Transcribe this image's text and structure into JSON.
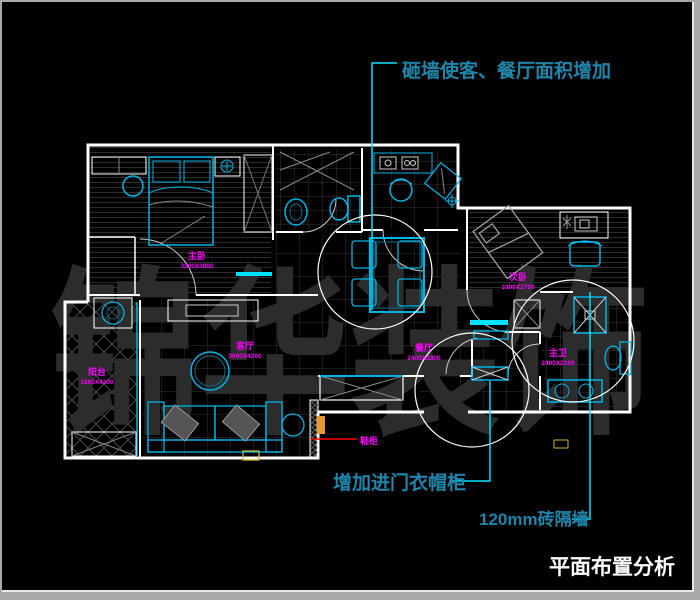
{
  "meta": {
    "background": "#000000",
    "frame_color": "#a9a9a9",
    "wall_color": "#ffffff",
    "furniture_color": "#00b4e6",
    "label_color": "#ff00ff",
    "annotation_text_color": "#1e86ab",
    "leader_color": "#00e0ff"
  },
  "title": {
    "text": "平面布置分析",
    "color": "#ffffff"
  },
  "watermark": {
    "text": "锦华装饰",
    "color": "#2c2c2c"
  },
  "annotations": {
    "demolish_wall": {
      "text": "砸墙使客、餐厅面积增加"
    },
    "coat_cabinet": {
      "text": "增加进门衣帽柜"
    },
    "brick_partition": {
      "text": "120mm砖隔墙"
    },
    "shoe_cabinet": {
      "text": "鞋柜"
    }
  },
  "rooms": [
    {
      "name": "主卧",
      "dim": "3300X3900"
    },
    {
      "name": "阳台",
      "dim": "1500X4200"
    },
    {
      "name": "客厅",
      "dim": "3900X4200"
    },
    {
      "name": "餐厅",
      "dim": "2400X3300"
    },
    {
      "name": "次卧",
      "dim": "3300X2700"
    },
    {
      "name": "主卫",
      "dim": "2400X2100"
    }
  ]
}
